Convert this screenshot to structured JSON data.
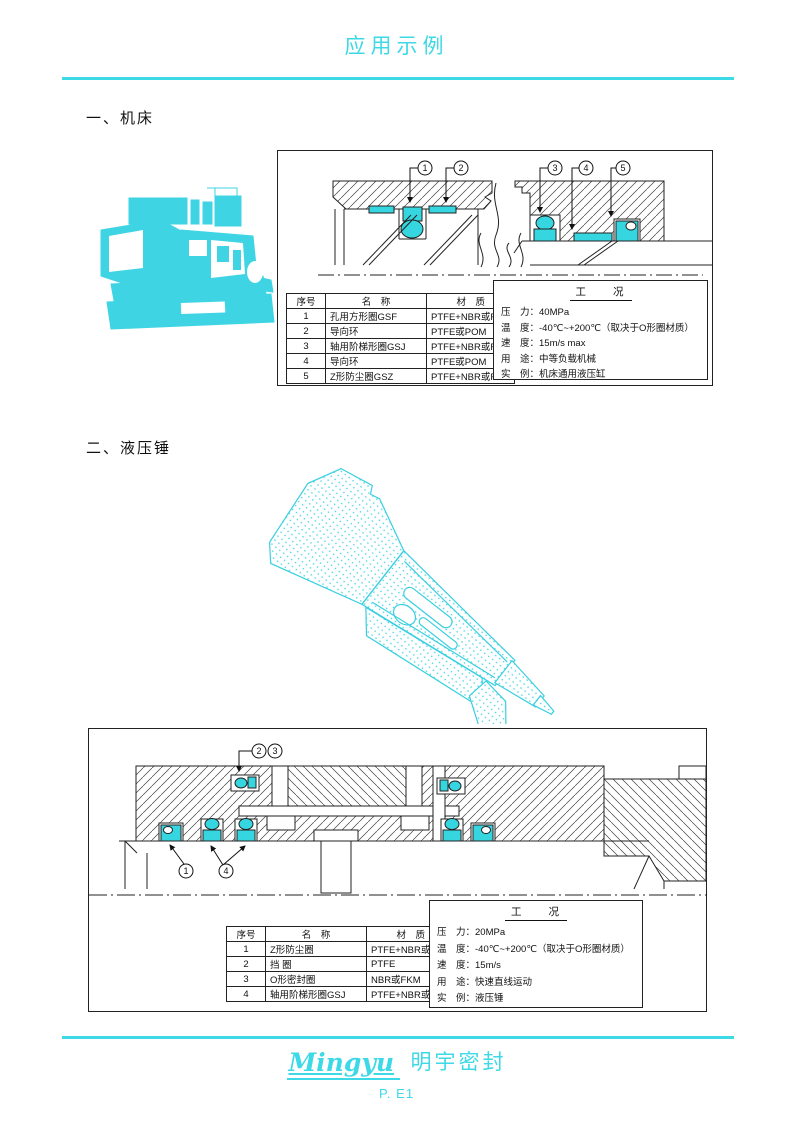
{
  "page": {
    "title": "应用示例",
    "accent_color": "#3dd9e6",
    "seal_color": "#36d6e0",
    "footer": {
      "brand_en": "Mingyu",
      "brand_cn": "明宇密封",
      "page_no": "P. E1"
    }
  },
  "sections": [
    {
      "heading": "一、机床",
      "illustration": "machine-tool-lathe",
      "callouts": [
        "1",
        "2",
        "3",
        "4",
        "5"
      ],
      "parts_table": {
        "headers": [
          "序号",
          "名　称",
          "材　质"
        ],
        "rows": [
          [
            "1",
            "孔用方形圈GSF",
            "PTFE+NBR或FKM"
          ],
          [
            "2",
            "导向环",
            "PTFE或POM"
          ],
          [
            "3",
            "轴用阶梯形圈GSJ",
            "PTFE+NBR或FKM"
          ],
          [
            "4",
            "导向环",
            "PTFE或POM"
          ],
          [
            "5",
            "Z形防尘圈GSZ",
            "PTFE+NBR或FKM"
          ]
        ]
      },
      "conditions": {
        "title": "工　　况",
        "lines": [
          "压　力：40MPa",
          "温　度：-40℃~+200℃（取决于O形圈材质）",
          "速　度：15m/s max",
          "用　途：中等负载机械",
          "实　例：机床通用液压缸"
        ]
      }
    },
    {
      "heading": "二、液压锤",
      "illustration": "hydraulic-hammer",
      "callouts": [
        "2",
        "3",
        "1",
        "4"
      ],
      "parts_table": {
        "headers": [
          "序号",
          "名　称",
          "材　质"
        ],
        "rows": [
          [
            "1",
            "Z形防尘圈",
            "PTFE+NBR或FKM"
          ],
          [
            "2",
            "挡 圈",
            "PTFE"
          ],
          [
            "3",
            "O形密封圈",
            "NBR或FKM"
          ],
          [
            "4",
            "轴用阶梯形圈GSJ",
            "PTFE+NBR或FKM"
          ]
        ]
      },
      "conditions": {
        "title": "工　　况",
        "lines": [
          "压　力：20MPa",
          "温　度：-40℃~+200℃（取决于O形圈材质）",
          "速　度：15m/s",
          "用　途：快速直线运动",
          "实　例：液压锤"
        ]
      }
    }
  ]
}
